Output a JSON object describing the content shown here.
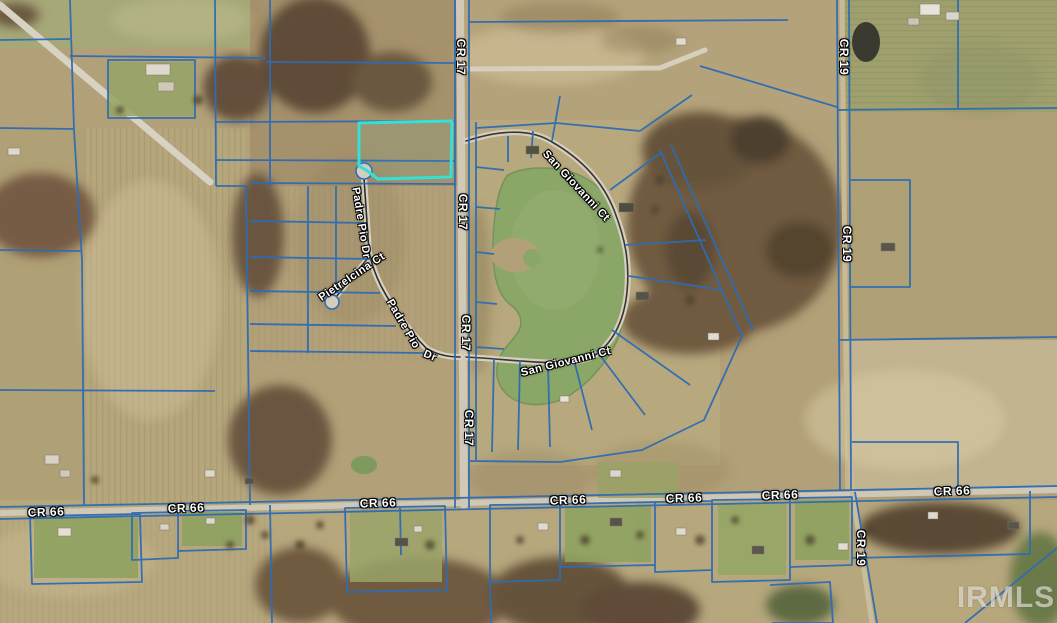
{
  "map": {
    "watermark": "IRMLS",
    "roads": {
      "cr17": "CR 17",
      "cr19": "CR 19",
      "cr66": "CR 66",
      "padre_pio_dr": "Padre Pio Dr",
      "padre_pio": "Padre Pio",
      "dr_suffix": "Dr",
      "pietrelcina_ct": "Pietrelcina Ct",
      "san_giovanni_ct": "San Giovanni Ct"
    },
    "colors": {
      "parcel_line": "#2e6cb4",
      "highlight": "#35e0d6",
      "pond": "#8aa768"
    }
  }
}
